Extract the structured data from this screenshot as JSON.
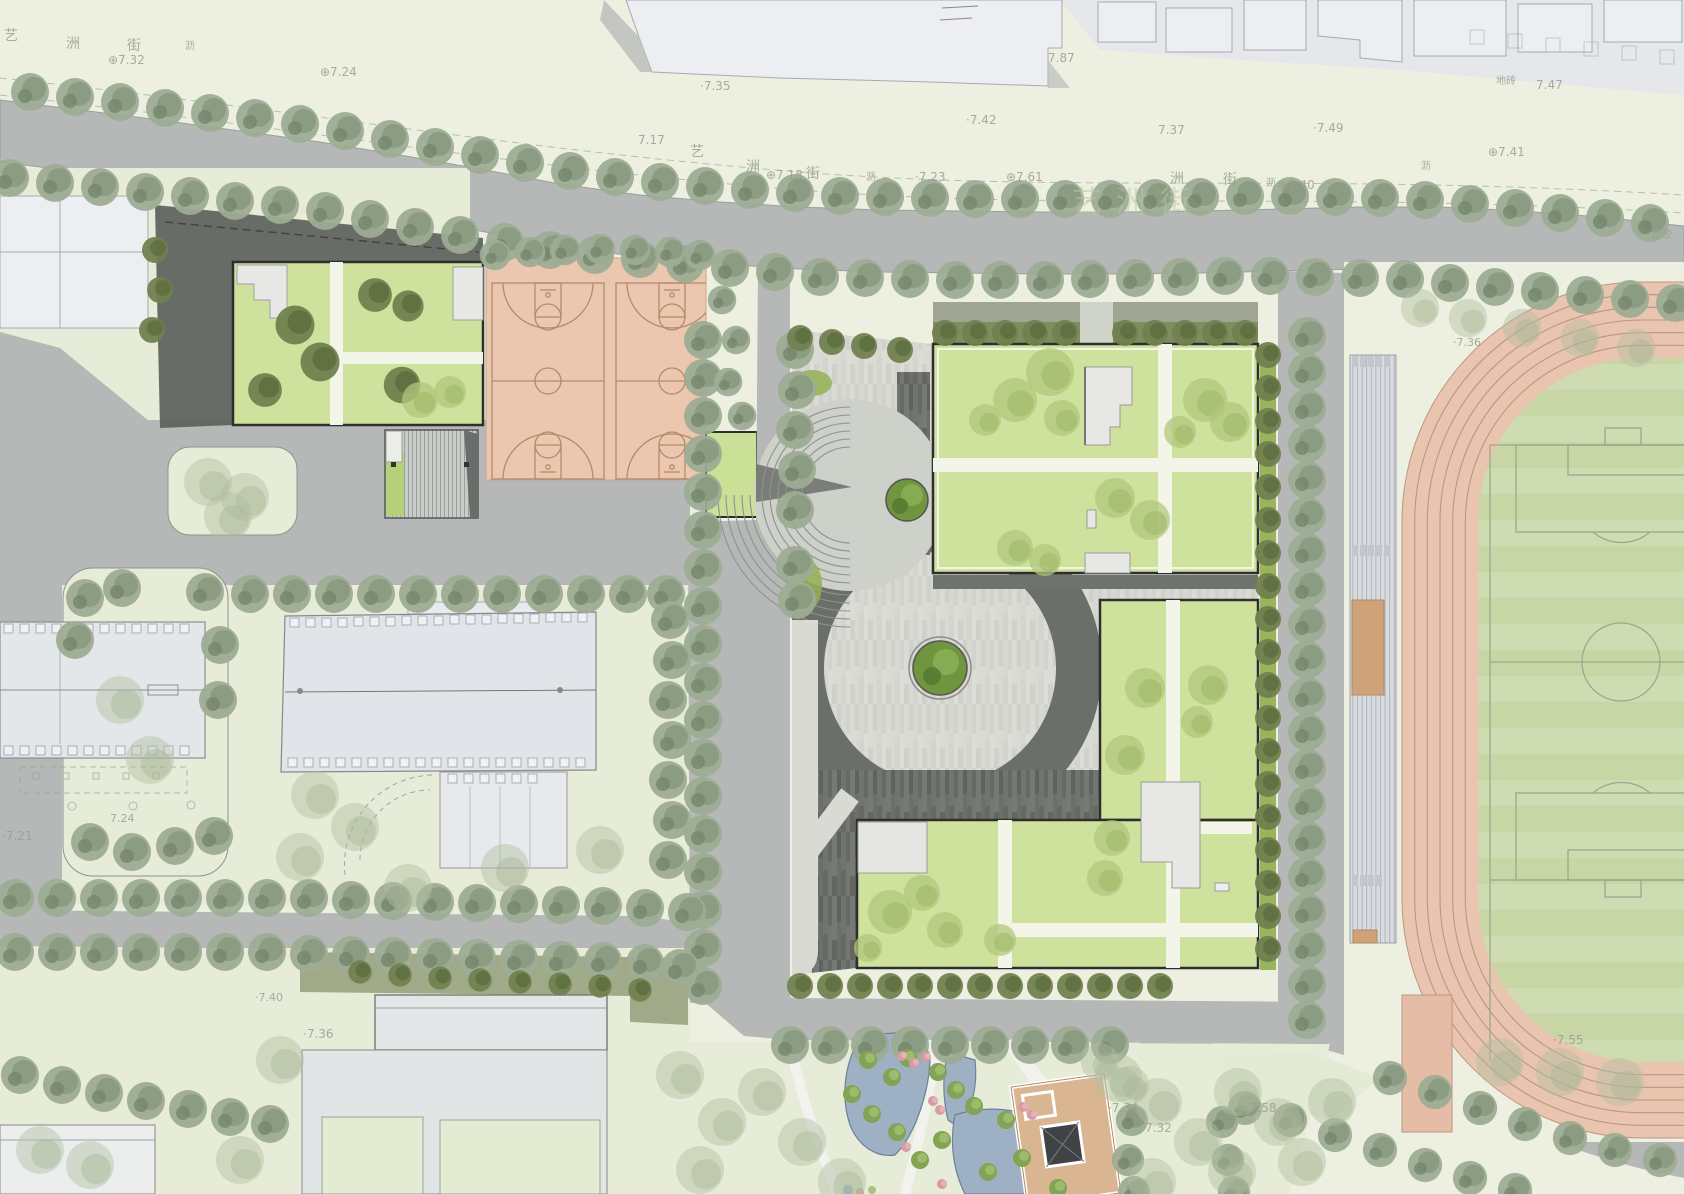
{
  "palette": {
    "paper": "#edf0e1",
    "paperDim": "#e7ecd8",
    "road": "#b5b8b6",
    "darkPaver": "#6b6f6a",
    "paver": "#d6d7d1",
    "grassRoof": "#cfe29d",
    "brightHedge": "#94b254",
    "hedge": "#71814f",
    "treeGray": "#9dac93",
    "ghostTree": "#b2bfa1",
    "roofTree": "#b0c77c",
    "salmon": "#eac7ae",
    "courtLine": "#b58a6b",
    "trackSalmon": "#e9c4ae",
    "laneLine": "#bb9683",
    "fieldGreen": "#c8d6a6",
    "pitchLine": "#9aa88e",
    "water": "#9db0c4",
    "waterEdge": "#6f8099",
    "tanRoof": "#d9b691",
    "tanDark": "#b08b60",
    "white": "#f2f3ee",
    "context": "#eceef2",
    "outline": "#2e2e2e",
    "standGray": "#d8dce0",
    "olive": "#99a37f",
    "labelColor": "#98a08e",
    "watermark": "#bcc5a8"
  },
  "site_features": {
    "basketball_courts": 2,
    "track_lanes": 6
  },
  "labels": [
    {
      "t": "艺",
      "x": 4,
      "y": 40,
      "s": 14
    },
    {
      "t": "洲",
      "x": 66,
      "y": 48,
      "s": 14
    },
    {
      "t": "街",
      "x": 127,
      "y": 50,
      "s": 14
    },
    {
      "t": "沥",
      "x": 185,
      "y": 49,
      "s": 10
    },
    {
      "t": "⊕7.32",
      "x": 108,
      "y": 64,
      "s": 12
    },
    {
      "t": "⊕7.24",
      "x": 320,
      "y": 76,
      "s": 12
    },
    {
      "t": "·7.35",
      "x": 700,
      "y": 90,
      "s": 12
    },
    {
      "t": "7.17",
      "x": 638,
      "y": 144,
      "s": 12
    },
    {
      "t": "艺",
      "x": 690,
      "y": 156,
      "s": 14
    },
    {
      "t": "洲",
      "x": 746,
      "y": 171,
      "s": 14
    },
    {
      "t": "⊕7.18",
      "x": 766,
      "y": 179,
      "s": 12
    },
    {
      "t": "街",
      "x": 806,
      "y": 178,
      "s": 14
    },
    {
      "t": "沥",
      "x": 866,
      "y": 180,
      "s": 10
    },
    {
      "t": "·7.23",
      "x": 915,
      "y": 181,
      "s": 12
    },
    {
      "t": "·7.42",
      "x": 966,
      "y": 124,
      "s": 12
    },
    {
      "t": "7.37",
      "x": 1158,
      "y": 134,
      "s": 12
    },
    {
      "t": "·7.49",
      "x": 1313,
      "y": 132,
      "s": 12
    },
    {
      "t": "⊕7.61",
      "x": 1006,
      "y": 181,
      "s": 12
    },
    {
      "t": "艺洲街",
      "x": 1072,
      "y": 212,
      "s": 30,
      "cls": "wm"
    },
    {
      "t": "洲",
      "x": 1170,
      "y": 183,
      "s": 14
    },
    {
      "t": "街",
      "x": 1223,
      "y": 184,
      "s": 14
    },
    {
      "t": "沥",
      "x": 1266,
      "y": 186,
      "s": 10
    },
    {
      "t": "⊕7.40",
      "x": 1278,
      "y": 189,
      "s": 12
    },
    {
      "t": "地砖",
      "x": 1496,
      "y": 84,
      "s": 10
    },
    {
      "t": "7.47",
      "x": 1536,
      "y": 89,
      "s": 12
    },
    {
      "t": "⊕7.41",
      "x": 1488,
      "y": 156,
      "s": 12
    },
    {
      "t": "沥",
      "x": 1421,
      "y": 169,
      "s": 10
    },
    {
      "t": "塑胶",
      "x": 1652,
      "y": 238,
      "s": 10
    },
    {
      "t": "7.87",
      "x": 1048,
      "y": 62,
      "s": 12
    },
    {
      "t": "·7.36",
      "x": 1453,
      "y": 346,
      "s": 11
    },
    {
      "t": "·7.55",
      "x": 1553,
      "y": 1044,
      "s": 12
    },
    {
      "t": "·7.34",
      "x": 1108,
      "y": 1112,
      "s": 12
    },
    {
      "t": "·7.58",
      "x": 1246,
      "y": 1112,
      "s": 12
    },
    {
      "t": "7.32",
      "x": 1145,
      "y": 1132,
      "s": 12
    },
    {
      "t": "·7.36",
      "x": 303,
      "y": 1038,
      "s": 12
    },
    {
      "t": "·7.40",
      "x": 255,
      "y": 1001,
      "s": 11
    },
    {
      "t": "·7.21",
      "x": 2,
      "y": 840,
      "s": 12
    },
    {
      "t": "7.24",
      "x": 110,
      "y": 822,
      "s": 11
    }
  ]
}
